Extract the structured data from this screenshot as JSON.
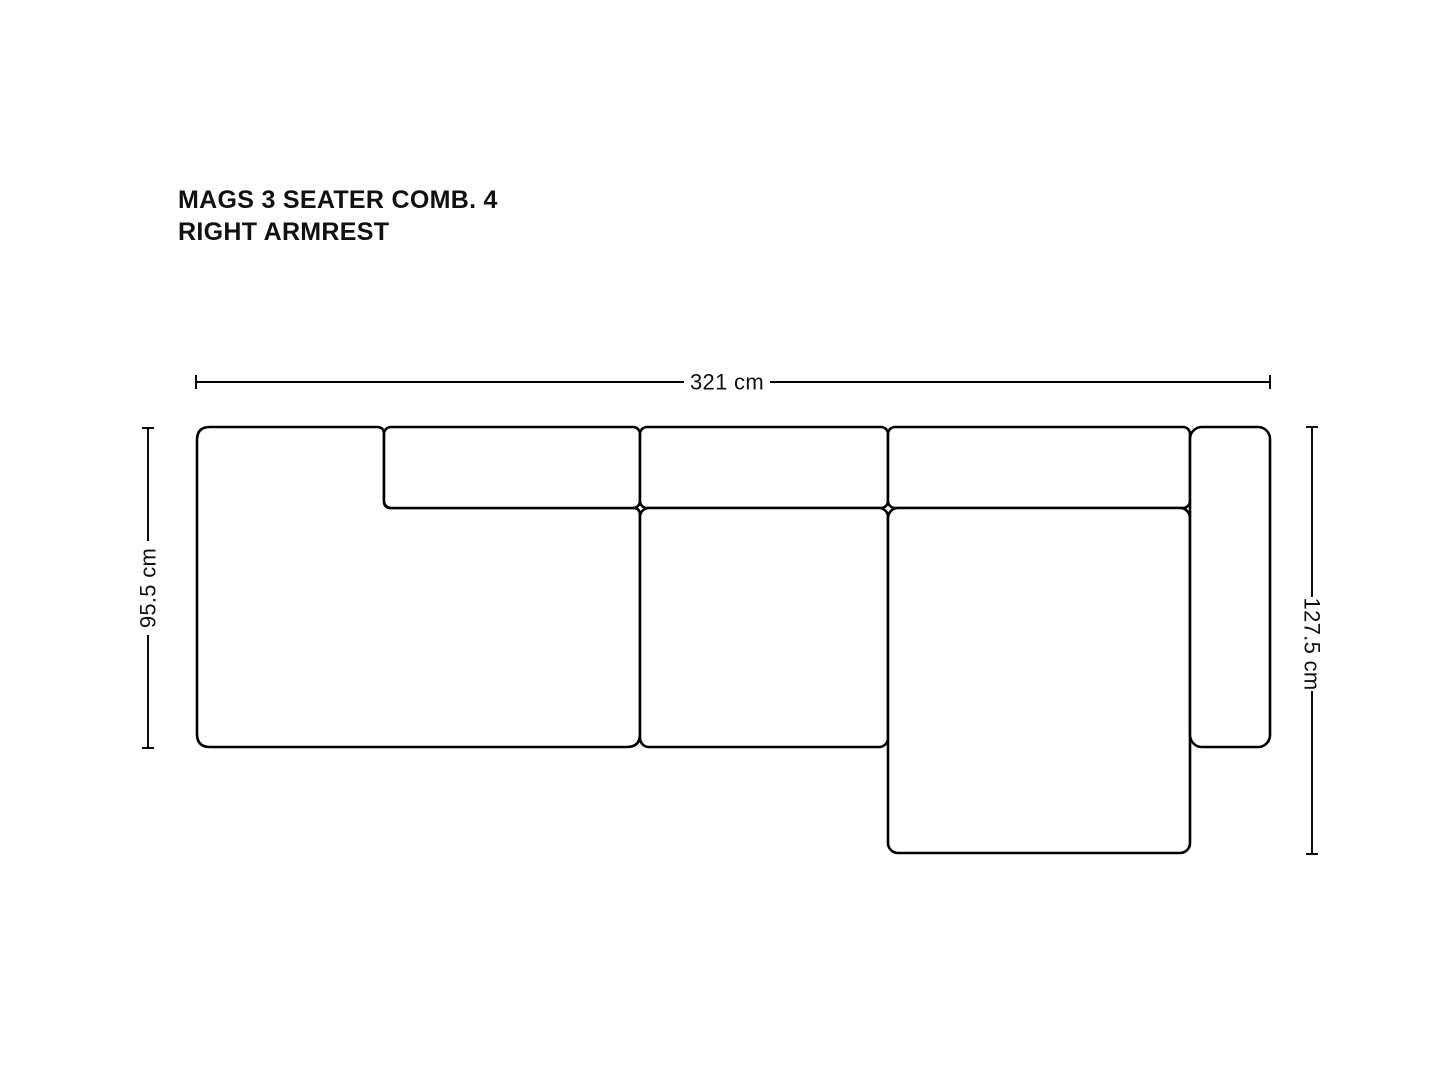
{
  "title": {
    "line1": "MAGS 3 SEATER COMB. 4",
    "line2": "RIGHT ARMREST"
  },
  "dimensions": {
    "overall_width": {
      "label": "321 cm",
      "value_cm": 321
    },
    "depth_left": {
      "label": "95.5 cm",
      "value_cm": 95.5
    },
    "depth_right": {
      "label": "127.5 cm",
      "value_cm": 127.5
    }
  },
  "diagram": {
    "type": "sofa-top-view-dimension-drawing",
    "line_color": "#000000",
    "background_color": "#ffffff",
    "modules": [
      "left-seat-module-with-left-armrest",
      "back-cushion-1",
      "back-cushion-2",
      "back-cushion-3",
      "middle-seat-cushion",
      "chaise-longue-seat",
      "right-armrest"
    ]
  }
}
